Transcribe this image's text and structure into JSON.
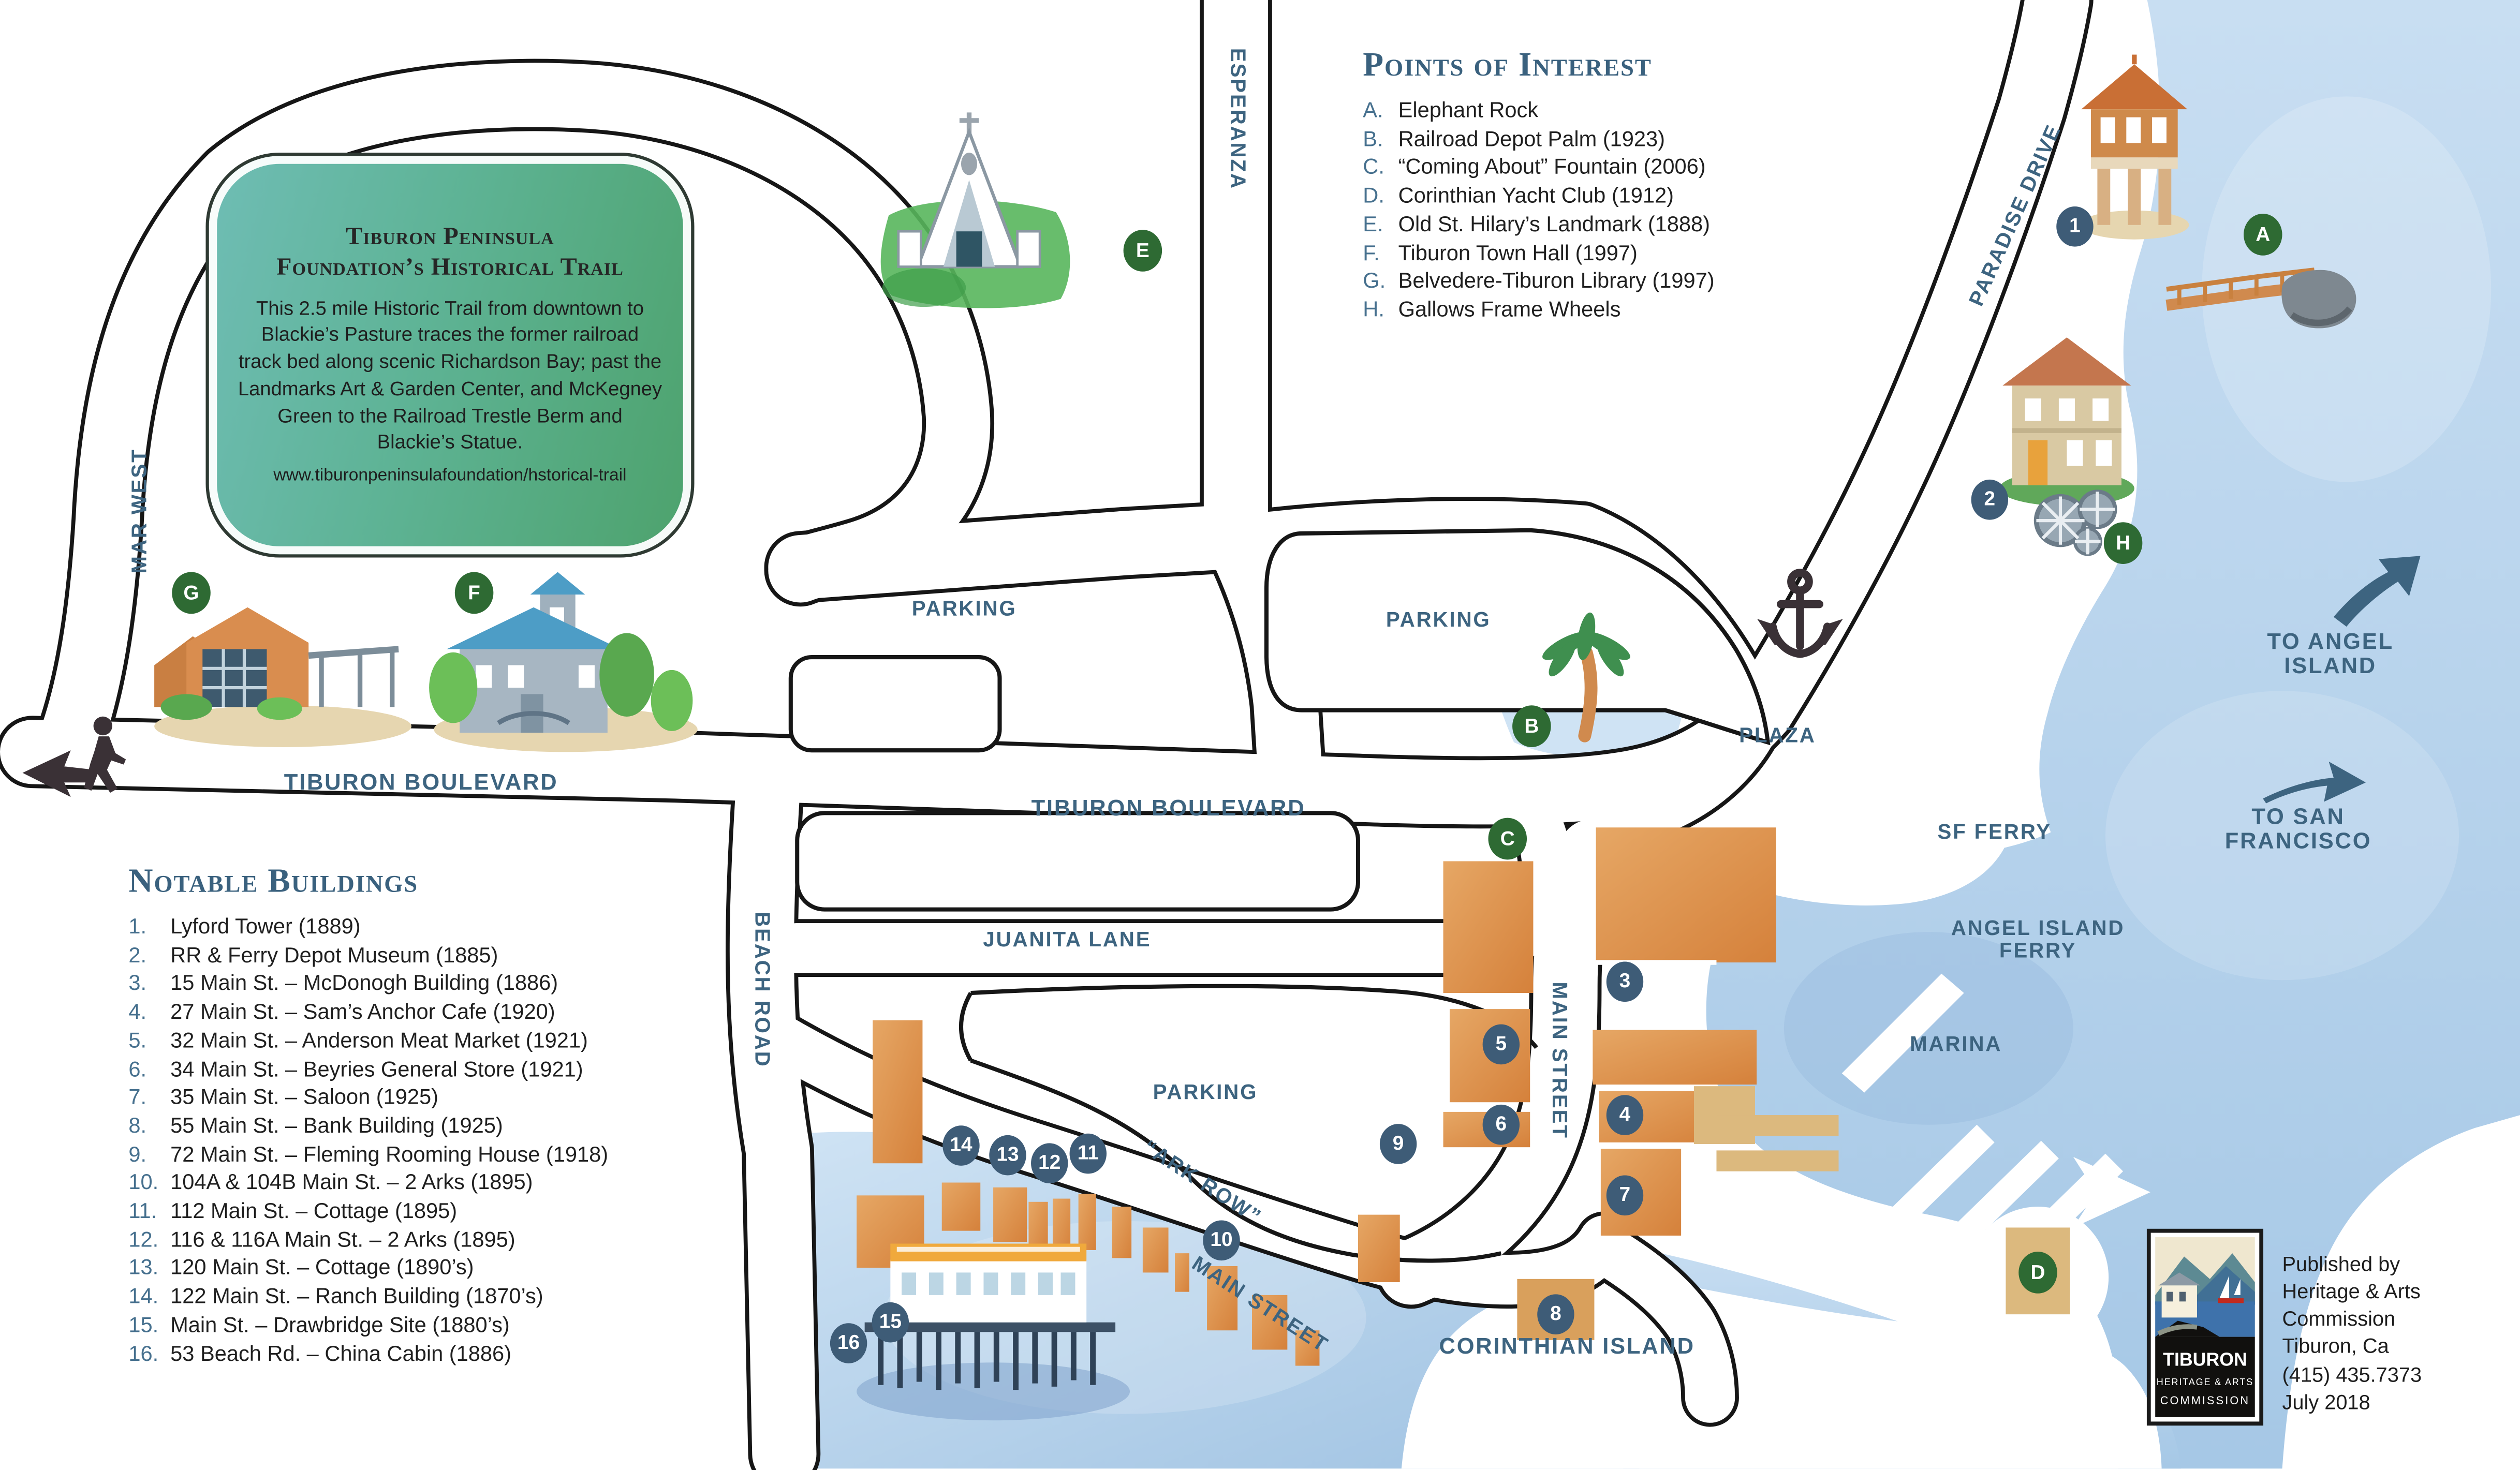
{
  "badge": {
    "title": "Tiburon Peninsula\nFoundation’s Historical Trail",
    "body": "This 2.5 mile Historic Trail from downtown to Blackie’s Pasture traces the former railroad track bed along scenic Richardson Bay; past the Landmarks Art & Garden Center, and McKegney Green to the Railroad Trestle Berm and Blackie’s Statue.",
    "url": "www.tiburonpeninsulafoundation/hstorical-trail"
  },
  "points_of_interest": {
    "heading": "Points of Interest",
    "items": [
      {
        "k": "A.",
        "t": "Elephant Rock"
      },
      {
        "k": "B.",
        "t": "Railroad Depot Palm (1923)"
      },
      {
        "k": "C.",
        "t": "“Coming About” Fountain (2006)"
      },
      {
        "k": "D.",
        "t": "Corinthian Yacht Club (1912)"
      },
      {
        "k": "E.",
        "t": "Old St. Hilary’s Landmark (1888)"
      },
      {
        "k": "F.",
        "t": "Tiburon Town Hall (1997)"
      },
      {
        "k": "G.",
        "t": "Belvedere-Tiburon Library (1997)"
      },
      {
        "k": "H.",
        "t": "Gallows Frame Wheels"
      }
    ]
  },
  "notable_buildings": {
    "heading": "Notable Buildings",
    "items": [
      {
        "k": "1.",
        "t": "Lyford Tower (1889)"
      },
      {
        "k": "2.",
        "t": "RR & Ferry Depot Museum (1885)"
      },
      {
        "k": "3.",
        "t": "15 Main St. – McDonogh Building (1886)"
      },
      {
        "k": "4.",
        "t": "27 Main St. – Sam’s Anchor Cafe (1920)"
      },
      {
        "k": "5.",
        "t": "32 Main St. – Anderson Meat Market (1921)"
      },
      {
        "k": "6.",
        "t": "34 Main St. – Beyries General Store (1921)"
      },
      {
        "k": "7.",
        "t": "35 Main St. – Saloon (1925)"
      },
      {
        "k": "8.",
        "t": "55 Main St. – Bank Building (1925)"
      },
      {
        "k": "9.",
        "t": "72 Main St. – Fleming Rooming House (1918)"
      },
      {
        "k": "10.",
        "t": "104A & 104B Main St. – 2 Arks (1895)"
      },
      {
        "k": "11.",
        "t": "112 Main St. – Cottage (1895)"
      },
      {
        "k": "12.",
        "t": "116 & 116A Main St. – 2 Arks (1895)"
      },
      {
        "k": "13.",
        "t": "120 Main St. – Cottage (1890’s)"
      },
      {
        "k": "14.",
        "t": "122 Main St. – Ranch Building (1870’s)"
      },
      {
        "k": "15.",
        "t": "Main St. – Drawbridge Site (1880’s)"
      },
      {
        "k": "16.",
        "t": "53 Beach Rd. – China Cabin (1886)"
      }
    ]
  },
  "labels": {
    "mar_west": "MAR WEST",
    "esperanza": "ESPERANZA",
    "paradise_drive": "PARADISE DRIVE",
    "tiburon_blvd_west": "TIBURON BOULEVARD",
    "tiburon_blvd_center": "TIBURON BOULEVARD",
    "juanita_lane": "JUANITA LANE",
    "beach_road": "BEACH ROAD",
    "main_street_vertical": "MAIN STREET",
    "main_street_diagonal": "MAIN STREET",
    "ark_row": "“ARK ROW”",
    "parking_left": "PARKING",
    "parking_right": "PARKING",
    "parking_center": "PARKING",
    "plaza": "PLAZA",
    "sf_ferry": "SF FERRY",
    "to_san_francisco": "TO SAN FRANCISCO",
    "to_angel_island": "TO ANGEL ISLAND",
    "angel_island_ferry": "ANGEL ISLAND\nFERRY",
    "marina": "MARINA",
    "corinthian_island": "CORINTHIAN ISLAND"
  },
  "markers": {
    "numbers": [
      "1",
      "2",
      "3",
      "4",
      "5",
      "6",
      "7",
      "8",
      "9",
      "10",
      "11",
      "12",
      "13",
      "14",
      "15",
      "16"
    ],
    "letters": [
      "A",
      "B",
      "C",
      "D",
      "E",
      "F",
      "G",
      "H"
    ]
  },
  "publisher": {
    "logo_line1": "TIBURON",
    "logo_line2": "HERITAGE & ARTS",
    "logo_line3": "COMMISSION",
    "text": "Published by\nHeritage & Arts\nCommission\nTiburon, Ca\n(415) 435.7373\nJuly 2018"
  },
  "colors": {
    "label_blue": "#3d6480",
    "list_key_blue": "#46708e",
    "marker_navy": "#3e5c77",
    "marker_green": "#2e6a33",
    "water": "#b7d3ec",
    "building_orange": "#dd9352",
    "building_tan": "#dcb97e",
    "badge_teal": "#5eb395",
    "road_outline": "#161616"
  }
}
